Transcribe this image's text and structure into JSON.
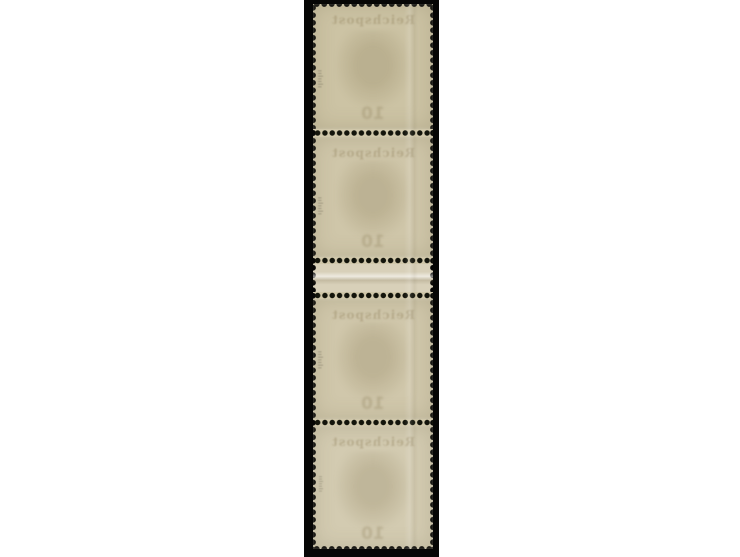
{
  "scene": {
    "type": "photograph",
    "subject": "Vertical strip of four mint postage stamps with gutter between units 2 and 3, shown from the gum side, mounted on black",
    "page_background": "#ffffff",
    "mount_color": "#060605"
  },
  "strip": {
    "stamp_count": 4,
    "layout": "stamp / perforation / stamp / perforation / gutter / perforation / stamp / perforation / stamp",
    "paper_color": "#cfc6a9",
    "gutter_color": "#d8d0b9",
    "perforation_hole_color": "#13140b",
    "showthrough": {
      "header_text": "Reichspost",
      "numeral": "10"
    },
    "expert_mark_glyphs": "ıılıılı"
  }
}
